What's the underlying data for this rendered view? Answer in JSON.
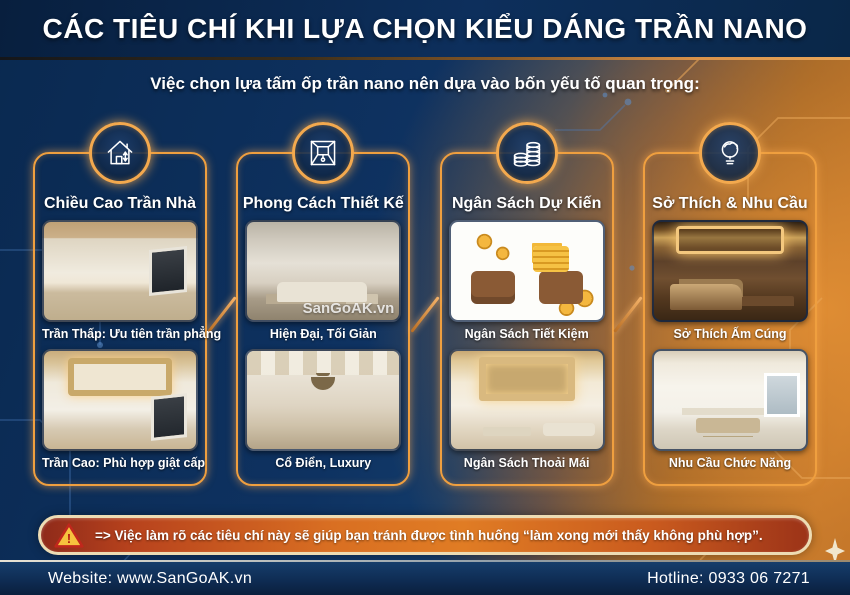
{
  "header": {
    "title": "CÁC TIÊU CHÍ KHI LỰA CHỌN KIỂU DÁNG TRẦN NANO",
    "subtitle": "Việc chọn lựa tấm ốp trần nano nên dựa vào bốn yếu tố quan trọng:"
  },
  "columns": [
    {
      "icon": "house-icon",
      "title": "Chiều Cao Trần Nhà",
      "cards": [
        {
          "caption": "Trần Thấp: Ưu tiên trần phẳng",
          "image": "empty-room-flat-ceiling"
        },
        {
          "caption": "Trần Cao: Phù hợp giật cấp",
          "image": "room-tiered-ceiling"
        }
      ]
    },
    {
      "icon": "ceiling-perspective-icon",
      "title": "Phong Cách Thiết Kế",
      "cards": [
        {
          "caption": "Hiện Đại, Tối Giản",
          "image": "modern-minimal-living-room",
          "watermark": "SanGoAK.vn"
        },
        {
          "caption": "Cổ Điển, Luxury",
          "image": "classic-luxury-dining-room"
        }
      ]
    },
    {
      "icon": "coin-stacks-icon",
      "title": "Ngân Sách Dự Kiến",
      "cards": [
        {
          "caption": "Ngân Sách Tiết Kiệm",
          "image": "wallets-and-coins-illustration"
        },
        {
          "caption": "Ngân Sách Thoải Mái",
          "image": "living-room-led-tiered-ceiling"
        }
      ]
    },
    {
      "icon": "idea-bulb-icon",
      "title": "Sở Thích & Nhu Cầu",
      "cards": [
        {
          "caption": "Sở Thích Ấm Cúng",
          "image": "warm-cozy-bedroom"
        },
        {
          "caption": "Nhu Cầu Chức Năng",
          "image": "white-functional-home-office"
        }
      ]
    }
  ],
  "warning": {
    "icon": "warning-triangle-icon",
    "text": "=> Việc làm rõ các tiêu chí này sẽ giúp bạn tránh được tình huống “làm xong mới thấy không phù hợp”."
  },
  "footer": {
    "website": "Website: www.SanGoAK.vn",
    "hotline": "Hotline: 0933 06 7271"
  },
  "colors": {
    "banner_navy": "#0b2a52",
    "background_navy": "#0e3463",
    "background_orange": "#c97d2f",
    "accent_gold": "#f2a648",
    "warning_red": "#c0392b",
    "warning_border_cream": "#eddcb4",
    "text_white": "#ffffff"
  }
}
